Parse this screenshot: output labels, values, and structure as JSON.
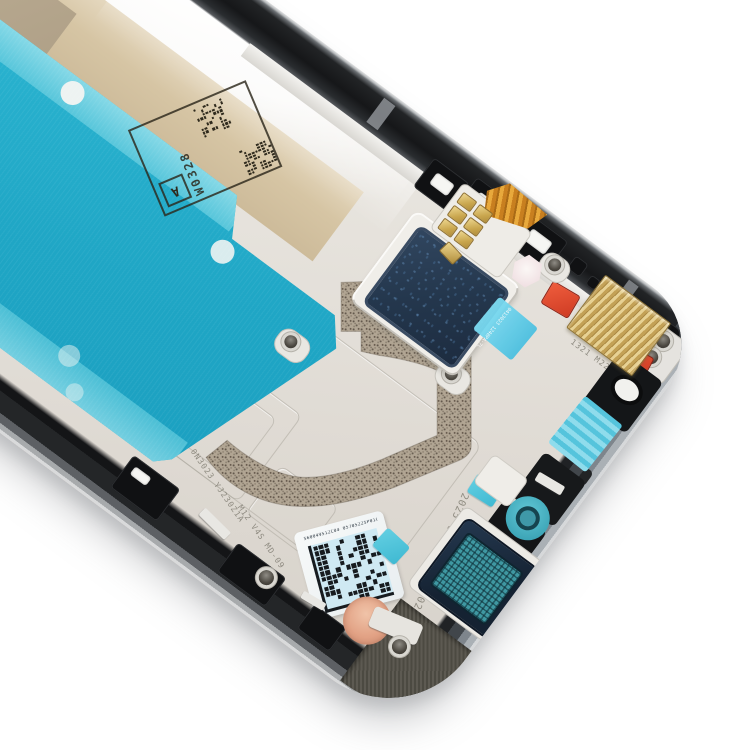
{
  "scene": {
    "description": "Product photo of a smartphone LCD middle frame front housing bezel plate, black frame, tilted diagonally on white background",
    "background_color": "#ffffff"
  },
  "part": {
    "frame_color_name": "black",
    "plate_color": "#e9e6e0",
    "adhesive_tape_color": "#22acc9",
    "backing_paper_color": "#d6c5a4",
    "bracket_film_color": "#24374d",
    "film_tab_color": "#5ecbe8",
    "gold_mesh_color": "#c9a75c",
    "red_clip_color": "#d6492f",
    "speaker_mesh_color": "#3f98a2",
    "copper_pad_color": "#e2a285",
    "sticker_color": "#cfe9f3"
  },
  "markings": {
    "stamp_letter": "A",
    "stamp_code": "W0328",
    "film_tab_code": "0413023 1248PA-7L",
    "sticker_top_code": "560049512C04 05705225P01C-2",
    "sticker_side_code": "2",
    "engraved_date_code": "2025 04 10 A 02402-2",
    "engraved_code_a": "0N3023 YJ230Z1A",
    "engraved_code_b": "M12 V4S MD-09",
    "engraved_code_c": "1321 M22M2"
  }
}
